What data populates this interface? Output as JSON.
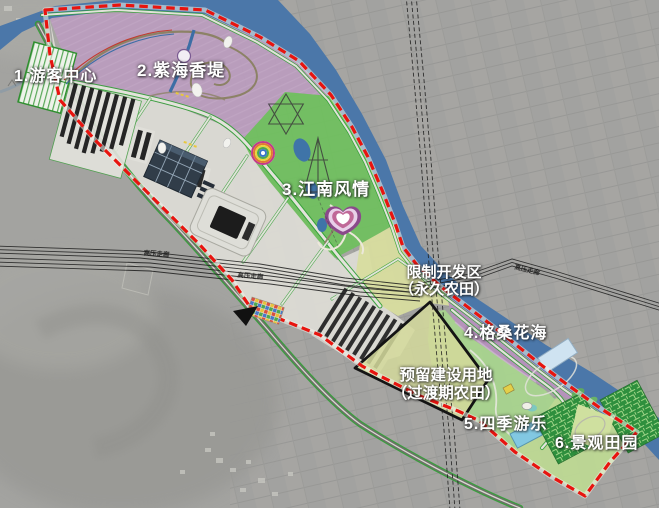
{
  "map": {
    "zones": [
      {
        "id": "visitor-center",
        "label": "1.游客中心",
        "color": "#dcdbd5"
      },
      {
        "id": "zihai-xiangdi",
        "label": "2.紫海香堤",
        "color": "#bb9cbe"
      },
      {
        "id": "jiangnan-fengqing",
        "label": "3.江南风情",
        "color": "#6fc05d"
      },
      {
        "id": "gesang-huahai",
        "label": "4.格桑花海",
        "color": "#b691bd"
      },
      {
        "id": "siji-youle",
        "label": "5.四季游乐",
        "color": "#a8d48e"
      },
      {
        "id": "jingguan-tianyuan",
        "label": "6.景观田园",
        "color": "#bdd894"
      }
    ],
    "restricted_zone": {
      "title": "限制开发区",
      "subtitle": "（永久农田）",
      "color": "#d8dd9f"
    },
    "reserved_land": {
      "title": "预留建设用地",
      "subtitle": "（过渡期农田）",
      "fill": "#d3d99b",
      "outline": "#141414"
    },
    "powerline_label": "高压走廊",
    "boundary_color": "#e8140f",
    "river_color": "#4b77a9",
    "road_edge_color": "#2f9e33"
  }
}
